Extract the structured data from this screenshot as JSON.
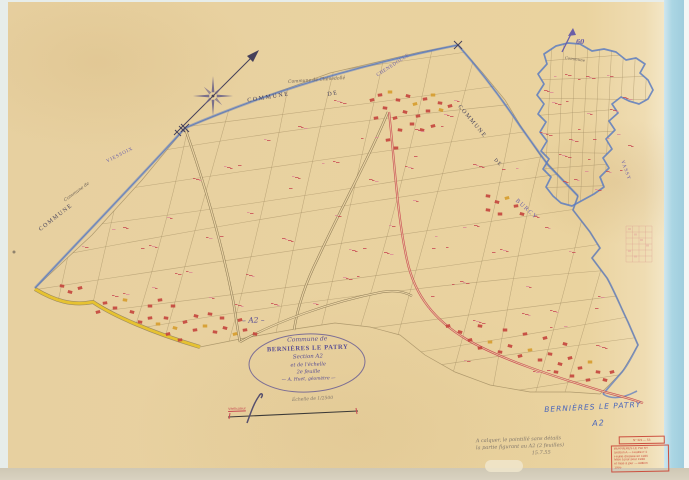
{
  "document": {
    "type": "Cadastral map scan",
    "section_mark": "– A2 –"
  },
  "cartouche": {
    "line1": "Commune de",
    "line2": "BERNIÈRES LE PATRY",
    "line3": "Section A2",
    "line4": "et de l'échelle",
    "line5": "2e feuille",
    "line6": "— A. Huet, géomètre —"
  },
  "neighbors": {
    "top_commune_word": "COMMUNE",
    "top_de_word": "DE",
    "top_name": "CHENEDOLLE",
    "top_script": "Commune de Chênedollé",
    "left_commune_word": "COMMUNE",
    "left_script": "Commune de",
    "left_name": "VIESSOIX",
    "right_commune_word": "COMMUNE",
    "right_de_word": "DE",
    "right_name": "BURCY"
  },
  "inset": {
    "number": "60",
    "script": "Commune",
    "side_name": "VASSY"
  },
  "footer": {
    "map_name": "BERNIÈRES LE PATRY",
    "map_section": "A2",
    "scale_note": "Échelle de 1/2500",
    "verif_note": "Vérificateur",
    "pencil_line1": "A calquer, le pointillé sans détails",
    "pencil_line2": "la partie figurant au A2 (2 feuilles)",
    "pencil_line3": "15.7.55"
  },
  "stamp": {
    "top": "N° 321 — 53",
    "lines": [
      "BERNIÈRES LE PATRY",
      "Section A — Feuille n°2",
      "Feuille dressée en 1935",
      "Mise à jour pour 1938",
      "et mise à jour — édition",
      "1955"
    ]
  },
  "colors": {
    "paper": "#e9d2a2",
    "scan_margin": "#e7edea",
    "scan_strip": "#abd6e4",
    "scan_white": "#f4f6f5",
    "bottom_strip": "#d9d2c0",
    "ink_sepia": "#a18c62",
    "ink_sepia_dark": "#7e6c48",
    "ink_dark": "#45405a",
    "ink_blue": "#5d7cc0",
    "road_red": "#c63b4a",
    "road_yellow": "#e6c231",
    "ink_red": "#c84a52",
    "ink_pink": "#dd8a96",
    "ink_purple": "#6b5fa8",
    "ink_cartouche": "#584d93",
    "hand_blue": "#4a66bb",
    "pencil": "#80766a",
    "stamp_red": "#cc5040",
    "bld_red": "#c4443c",
    "bld_yellow": "#d69c2c"
  }
}
